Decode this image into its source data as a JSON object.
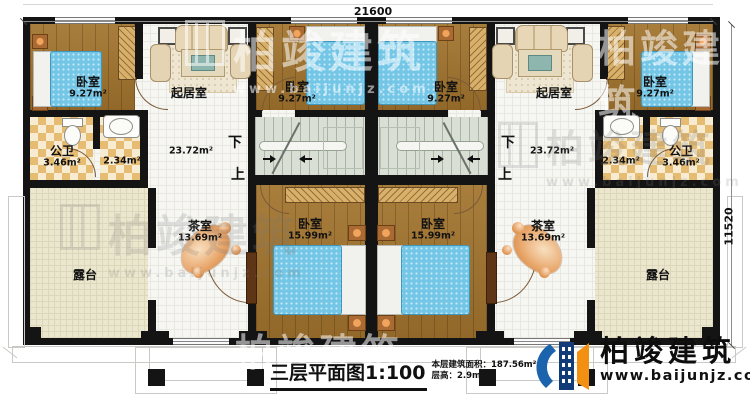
{
  "dimensions": {
    "top": "21600",
    "right": "11520"
  },
  "rooms": {
    "bedroom_small": {
      "name": "卧室",
      "area": "9.27m²"
    },
    "living": {
      "name": "起居室",
      "area": "23.72m²"
    },
    "bath": {
      "name": "公卫",
      "area": "3.46m²"
    },
    "bath2": {
      "area": "2.34m²"
    },
    "tea": {
      "name": "茶室",
      "area": "13.69m²"
    },
    "bedroom_large": {
      "name": "卧室",
      "area": "15.99m²"
    },
    "terrace": {
      "name": "露台"
    },
    "stair_down": "下",
    "stair_up": "上"
  },
  "title": {
    "main": "三层平面图1:100",
    "area_line": "本层建筑面积：187.56m²",
    "height_line": "层高：2.9m"
  },
  "brand": {
    "name": "柏竣建筑",
    "url": "www.baijunjz.com"
  },
  "watermark": {
    "name": "柏竣建筑",
    "url": "www.baijunjz.com"
  },
  "colors": {
    "wall": "#141414",
    "wood": "#a2742e",
    "bed": "#74c6e6",
    "brand_blue": "#123c77",
    "brand_orange": "#f29111"
  }
}
